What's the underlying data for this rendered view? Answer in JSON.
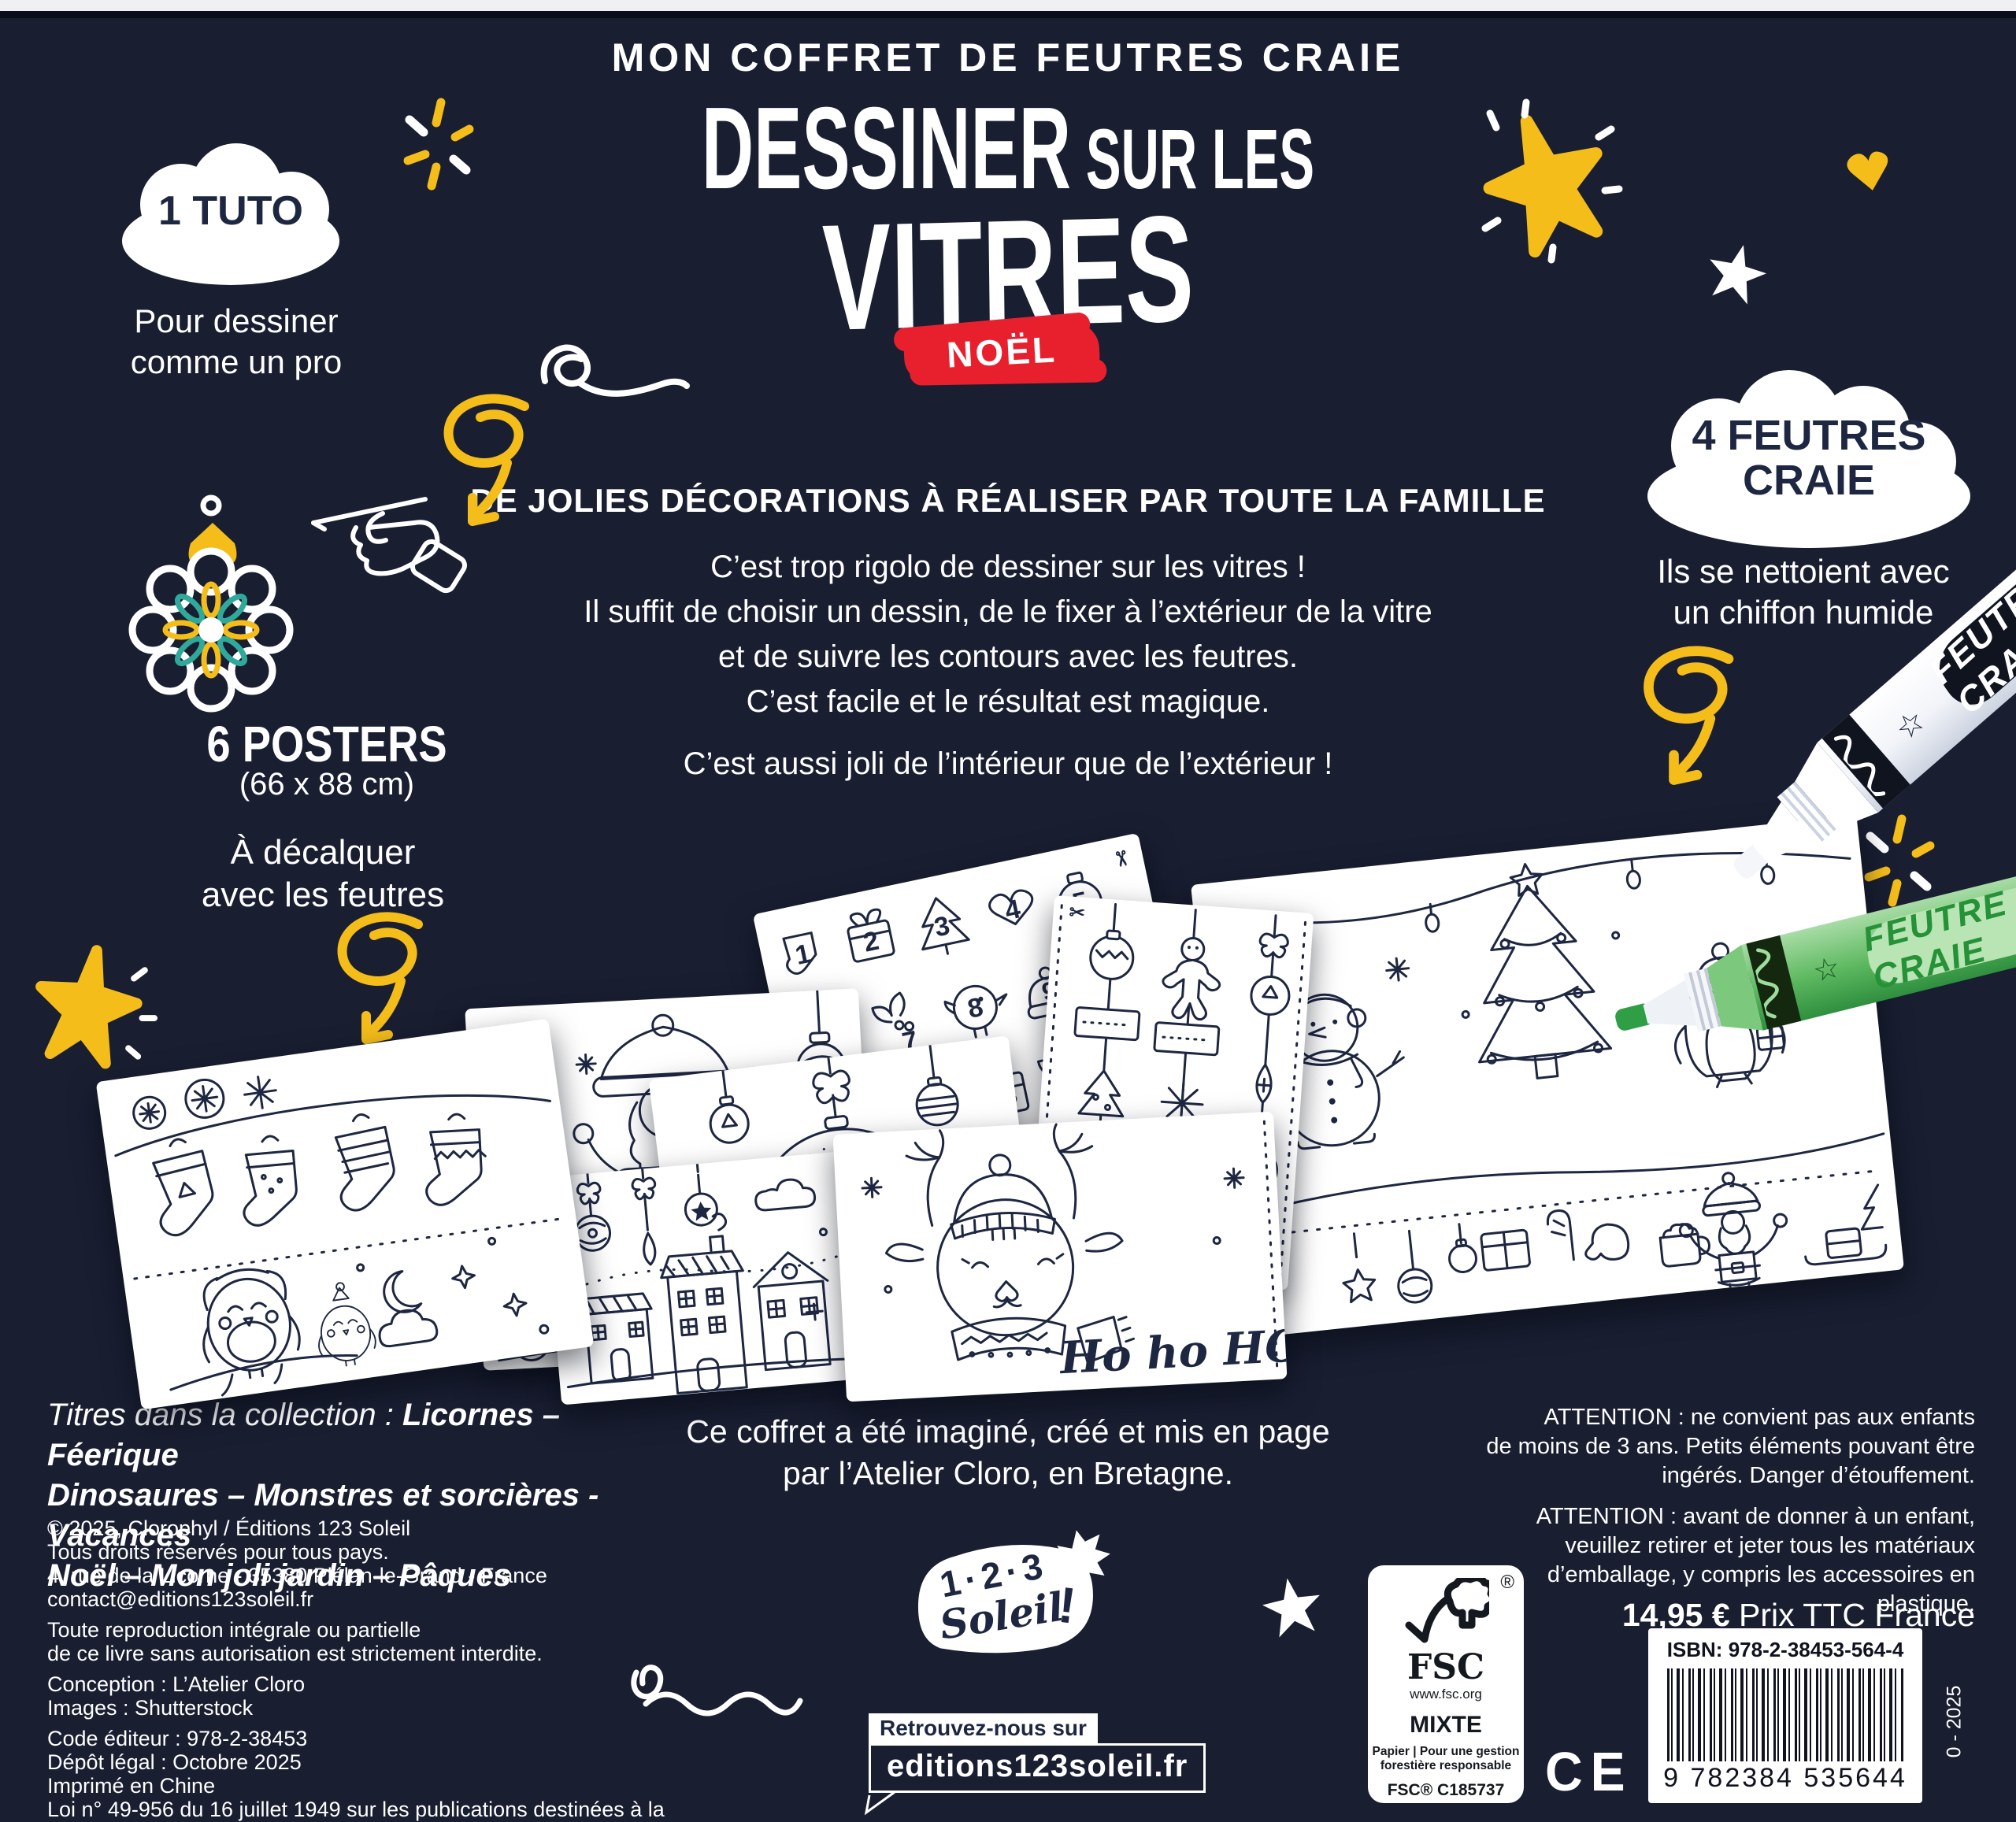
{
  "colors": {
    "bg": "#191e31",
    "ink": "#1e2742",
    "yellow": "#f4bd1a",
    "teal": "#2fa99b",
    "red": "#e8202e",
    "green": "#3fae4e"
  },
  "header": {
    "kicker": "MON COFFRET DE FEUTRES CRAIE",
    "title_big": "DESSINER",
    "title_small": "SUR LES",
    "title_word": "VITRES",
    "badge": "NOËL"
  },
  "tuto": {
    "cloud": "1 TUTO",
    "line1": "Pour dessiner",
    "line2": "comme un pro"
  },
  "posters_info": {
    "title": "6 POSTERS",
    "size": "(66 x 88 cm)",
    "line1": "À décalquer",
    "line2": "avec les feutres"
  },
  "feutres": {
    "cloud1": "4 FEUTRES",
    "cloud2": "CRAIE",
    "line1": "Ils se nettoient avec",
    "line2": "un chiffon humide",
    "marker_label": "FEUTRE CRAIE"
  },
  "intro": {
    "headline": "DE JOLIES DÉCORATIONS À RÉALISER PAR TOUTE LA FAMILLE",
    "p1": "C’est trop rigolo de dessiner sur les vitres !",
    "p2": "Il suffit de choisir un dessin, de le fixer à l’extérieur de la vitre",
    "p3": "et de suivre les contours avec les feutres.",
    "p4": "C’est facile et le résultat est magique.",
    "p5": "C’est aussi joli de l’intérieur que de l’extérieur !"
  },
  "poster_texts": {
    "ho1": "HO!",
    "ho2": "HO!",
    "ho3": "HO!",
    "joyeux": "JOYEUX",
    "noel_script": "Noël",
    "noel_tag": "NOËL",
    "hohoho": "Ho ho HO",
    "numbers": [
      "1",
      "2",
      "3",
      "4",
      "5",
      "6",
      "7",
      "8",
      "9",
      "13",
      "17",
      "21",
      "25"
    ]
  },
  "collection": {
    "prefix": "Titres dans la collection : ",
    "bold1": "Licornes – Féerique",
    "line2": "Dinosaures – Monstres et sorcières - Vacances",
    "line3": "Noël – Mon joli jardin – Pâques"
  },
  "legal": {
    "l1": "© 2025, Clorophyl / Éditions 123 Soleil",
    "l2": "Tous droits réservés pour tous pays.",
    "l3": "4, rue de la Licorne - 35380 Plélan-le-Grand - France",
    "l4": "contact@editions123soleil.fr",
    "l5": "Toute reproduction intégrale ou partielle",
    "l6": "de ce livre sans autorisation est strictement interdite.",
    "l7": "Conception : L’Atelier Cloro",
    "l8": "Images : Shutterstock",
    "l9": "Code éditeur : 978-2-38453",
    "l10": "Dépôt légal : Octobre 2025",
    "l11": "Imprimé en Chine",
    "l12": "Loi n° 49-956 du 16 juillet 1949 sur les publications destinées à la jeunesse"
  },
  "credit": {
    "line1": "Ce coffret a été imaginé, créé et mis en page",
    "line2": "par l’Atelier Cloro, en Bretagne."
  },
  "logo": {
    "top": "1·2·3",
    "name": "Soleil",
    "bang": "!"
  },
  "findus": {
    "label": "Retrouvez-nous sur",
    "site": "editions123soleil.fr"
  },
  "warnings": {
    "a1l1": "ATTENTION : ne convient pas aux enfants",
    "a1l2": "de moins de 3 ans. Petits éléments pouvant être",
    "a1l3": "ingérés. Danger d’étouffement.",
    "a2l1": "ATTENTION : avant de donner à un enfant,",
    "a2l2": "veuillez retirer et jeter tous les matériaux",
    "a2l3": "d’emballage, y compris les accessoires en plastique."
  },
  "purchase": {
    "price": "14,95 €",
    "price_suffix": " Prix TTC France",
    "isbn": "ISBN: 978-2-38453-564-4",
    "barcode": "9 782384 535644",
    "edition": "0 - 2025"
  },
  "fsc": {
    "reg": "®",
    "acronym": "FSC",
    "url": "www.fsc.org",
    "grade": "MIXTE",
    "desc1": "Papier | Pour une gestion",
    "desc2": "forestière responsable",
    "cert": "FSC® C185737"
  },
  "ce": "CE"
}
